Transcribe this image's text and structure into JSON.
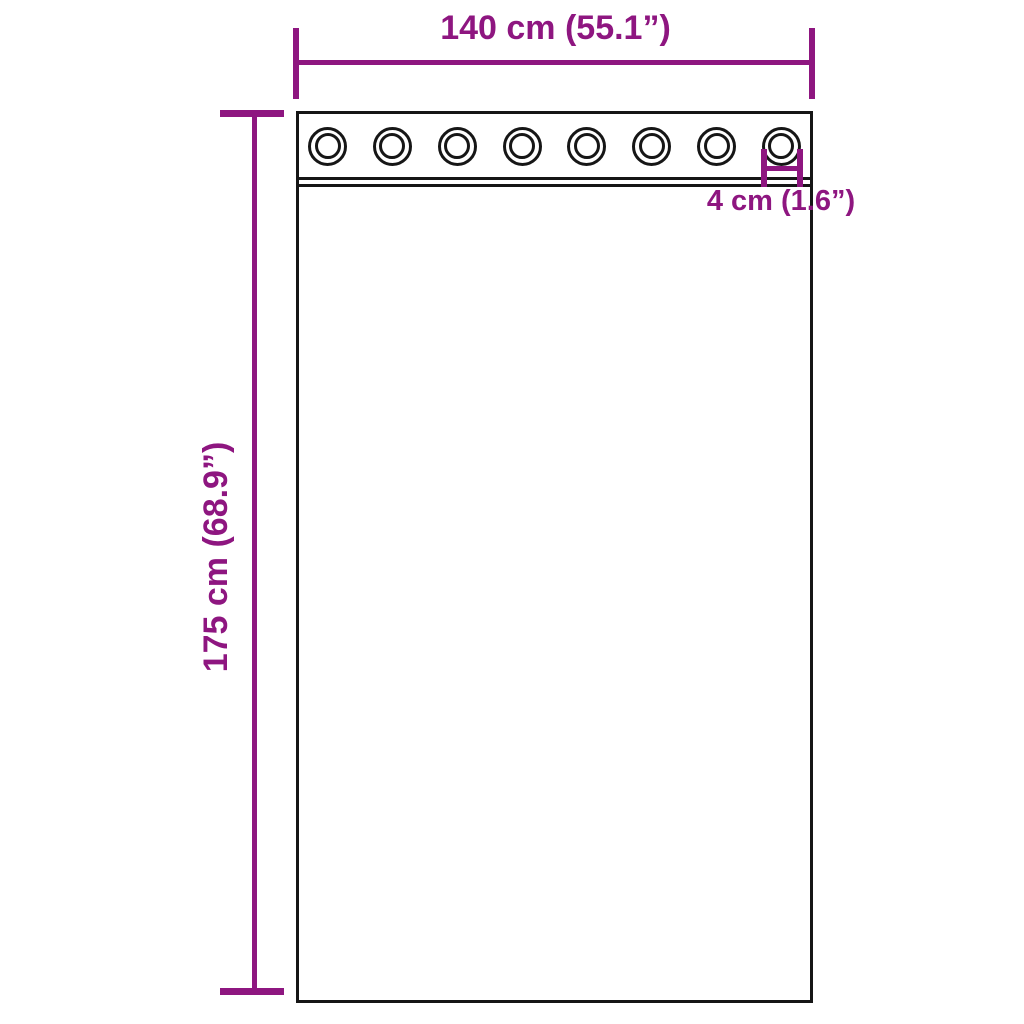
{
  "diagram": {
    "subject": "grommet-curtain-dimension-diagram",
    "colors": {
      "dimension": "#8E1680",
      "outline": "#161616",
      "background": "#FFFFFF"
    },
    "curtain": {
      "grommet_count": 8
    },
    "dimensions": {
      "width": {
        "label": "140 cm (55.1”)",
        "value_cm": 140,
        "value_in": 55.1
      },
      "height": {
        "label": "175 cm (68.9”)",
        "value_cm": 175,
        "value_in": 68.9
      },
      "grommet": {
        "label": "4 cm (1.6”)",
        "value_cm": 4,
        "value_in": 1.6
      }
    }
  }
}
